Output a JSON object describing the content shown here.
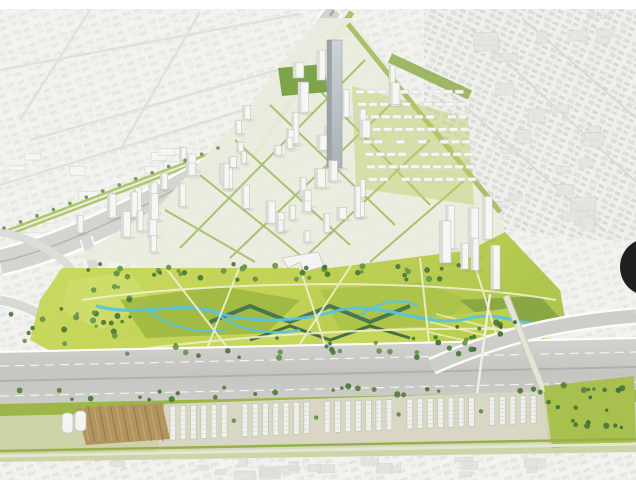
{
  "watermark": {
    "text": "yuus",
    "color": "#d8d8d4"
  },
  "overlay": {
    "cursor_dot_color": "#202020"
  },
  "scene": {
    "palette": {
      "context_base": "#f2f3ef",
      "context_block": "#e2e3df",
      "context_line": "#dfe0dc",
      "building_white": "#f6f7f4",
      "building_stroke": "#c2c5c0",
      "building_shade": "#dadcd7",
      "landmark_tower_gray": "#c3c8cc",
      "landmark_tower_side": "#9aa1a7",
      "road_gray": "#cdcec9",
      "road_dark": "#adaeaa",
      "lane_white": "#f2f2ef",
      "park_lime": "#c3d355",
      "park_mid": "#a9c247",
      "park_olive": "#94b03c",
      "park_dark": "#6f9440",
      "wetland_dark": "#3c6b4f",
      "tree_dark": "#4a7738",
      "tree_mid": "#67944b",
      "water_blue": "#57c4e3",
      "pond_blue": "#3fa9d0",
      "path_cream": "#f2efcd",
      "verge_green": "#9cb748",
      "terrace_ground": "#d9d7c3",
      "terrace_white": "#eff1ec",
      "allotment_brown": "#b2945f",
      "allotment_dark": "#8f744a",
      "street_grid_green": "#96b351",
      "boulevard_green": "#a6bf55"
    }
  }
}
